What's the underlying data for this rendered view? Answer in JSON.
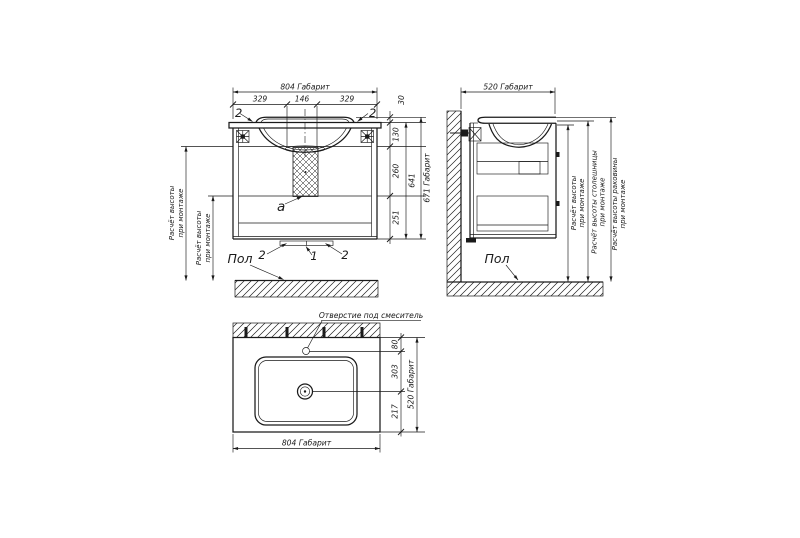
{
  "drawing": {
    "bg_color": "#ffffff",
    "line_color": "#1a1a1a",
    "front": {
      "dim_width": "804 Габарит",
      "dim_left": "329",
      "dim_center": "146",
      "dim_right": "329",
      "dim_rim_height": "30",
      "dim_top_section": "130",
      "dim_mid_section": "260",
      "dim_bottom_section": "251",
      "dim_body_height": "641",
      "dim_total_height": "671 Габарит",
      "callout_hinge_left": "2",
      "callout_hinge_right": "2",
      "callout_rail_left": "2",
      "callout_rail_center": "1",
      "callout_rail_right": "2",
      "label_siphon": "a",
      "label_floor": "Пол",
      "note_mount_1": [
        "Расчёт высоты",
        "при монтаже"
      ],
      "note_mount_2": [
        "Расчёт высоты",
        "при монтаже"
      ]
    },
    "side": {
      "dim_depth": "520 Габарит",
      "label_floor": "Пол",
      "note_height": [
        "Расчёт высоты",
        "при монтаже"
      ],
      "note_countertop": [
        "Расчёт высоты столешницы",
        "при монтаже"
      ],
      "note_basin": [
        "Расчёт высоты раковины",
        "при монтаже"
      ]
    },
    "plan": {
      "note_faucet": "Отверстие под смеситель",
      "dim_faucet_offset": "80",
      "dim_drain_offset": "303",
      "dim_front_offset": "217",
      "dim_depth": "520 Габарит",
      "dim_width": "804 Габарит"
    }
  }
}
